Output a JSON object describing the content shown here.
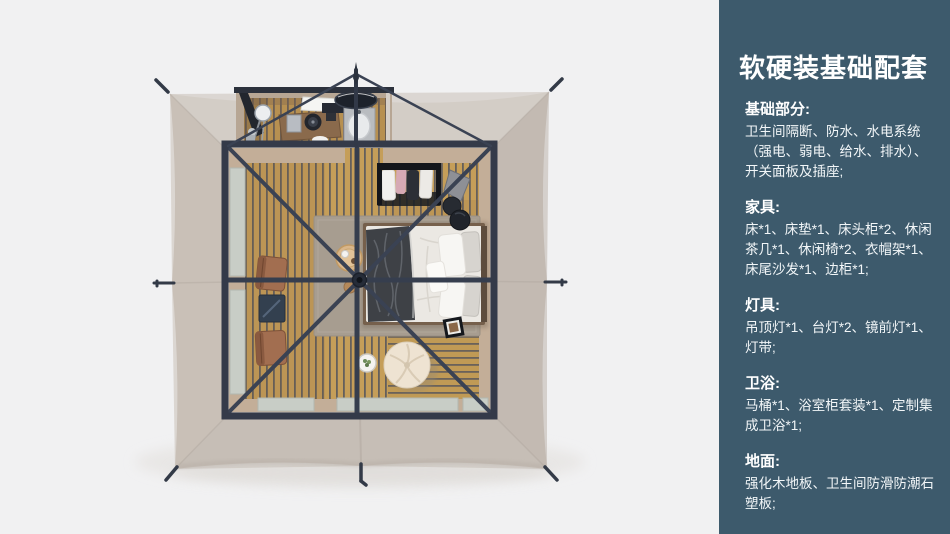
{
  "panel": {
    "bg_color": "#3d5a6c",
    "text_color": "#ffffff",
    "title": "软硬装基础配套",
    "sections": [
      {
        "heading": "基础部分:",
        "body": "卫生间隔断、防水、水电系统（强电、弱电、给水、排水）、开关面板及插座;"
      },
      {
        "heading": "家具:",
        "body": "床*1、床垫*1、床头柜*2、休闲茶几*1、休闲椅*2、衣帽架*1、床尾沙发*1、边柜*1;"
      },
      {
        "heading": "灯具:",
        "body": "吊顶灯*1、台灯*2、镜前灯*1、灯带;"
      },
      {
        "heading": "卫浴:",
        "body": "马桶*1、浴室柜套装*1、定制集成卫浴*1;"
      },
      {
        "heading": "地面:",
        "body": "强化木地板、卫生间防滑防潮石塑板;"
      }
    ]
  },
  "illustration": {
    "colors": {
      "background": "#f1f1f2",
      "canvas_fabric": "#c9c0b8",
      "frame": "#343a49",
      "wood_floor": "#c59e59",
      "bedding": "#ebe8e3",
      "rug": "#a79d90",
      "leather_chair": "#a26e50",
      "panel_accent": "#3d5a6c"
    }
  }
}
